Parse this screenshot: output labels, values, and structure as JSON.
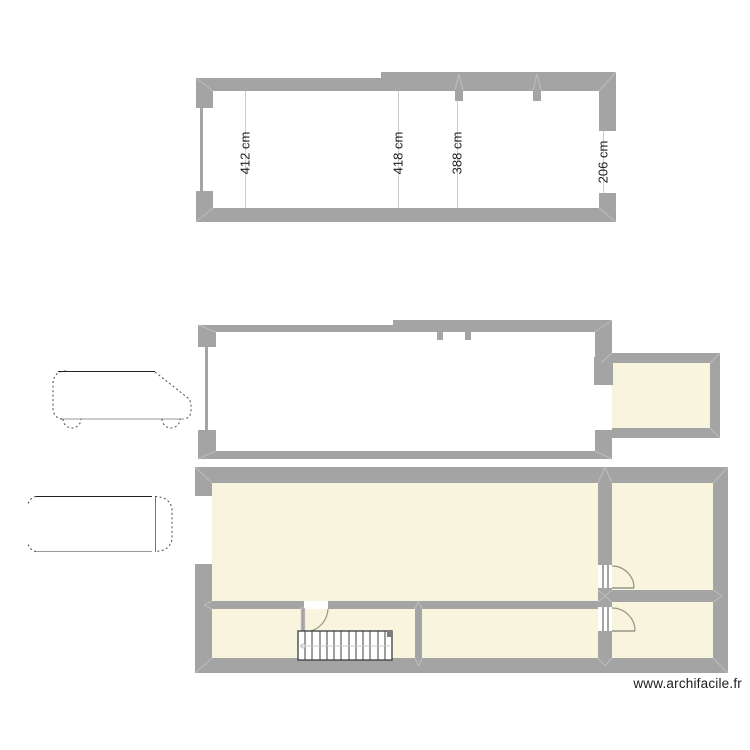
{
  "colors": {
    "wall": "#a4a4a4",
    "wall-light": "#bdbdbd",
    "room": "#f8f4de",
    "dim-line": "#cccccc",
    "text": "#1f1f1f",
    "door": "#96968a",
    "stair": "#3c3c3c",
    "vehicle": "#4a4a4a"
  },
  "upper_plan": {
    "dimensions": [
      {
        "label": "412 cm"
      },
      {
        "label": "418 cm"
      },
      {
        "label": "388 cm"
      },
      {
        "label": "206 cm"
      }
    ]
  },
  "icons": {
    "van_side": "van-side-view-icon",
    "van_top": "van-top-view-icon",
    "door": "door-swing-icon",
    "stairs": "staircase-icon",
    "window": "window-opening-icon"
  },
  "watermark": {
    "text": "www.archifacile.fr"
  }
}
